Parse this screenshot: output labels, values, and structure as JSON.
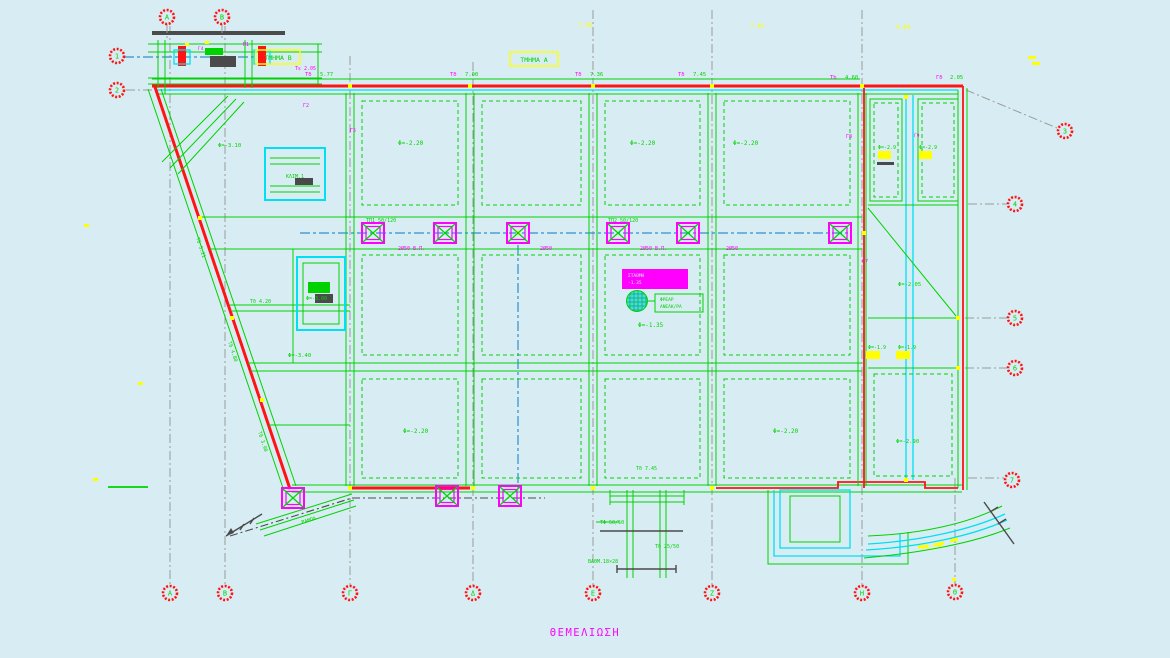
{
  "drawing": {
    "title": "ΘΕΜΕΛΙΩΣΗ",
    "section_box_a": "ΤΜΗΜΑ Α",
    "section_box_b": "ΤΜΗΜΑ Β"
  },
  "colors": {
    "bg": "#d8edf3",
    "green": "#00d200",
    "red": "#ff1414",
    "cyan": "#00e0f2",
    "magenta": "#ff00ff",
    "yellow": "#ffff00",
    "blue": "#2f8fd0",
    "gray": "#9a9a9a",
    "dark": "#4a4a4a"
  },
  "grid": {
    "markers": [
      {
        "x": 170,
        "y": 593,
        "label": "Α"
      },
      {
        "x": 225,
        "y": 593,
        "label": "Β"
      },
      {
        "x": 350,
        "y": 593,
        "label": "Γ"
      },
      {
        "x": 473,
        "y": 593,
        "label": "Δ"
      },
      {
        "x": 593,
        "y": 593,
        "label": "Ε"
      },
      {
        "x": 712,
        "y": 593,
        "label": "Ζ"
      },
      {
        "x": 862,
        "y": 593,
        "label": "Η"
      },
      {
        "x": 955,
        "y": 592,
        "label": "Θ"
      },
      {
        "x": 167,
        "y": 17,
        "label": "Α"
      },
      {
        "x": 222,
        "y": 17,
        "label": "Β"
      },
      {
        "x": 117,
        "y": 56,
        "label": "1"
      },
      {
        "x": 117,
        "y": 90,
        "label": "2"
      },
      {
        "x": 1065,
        "y": 131,
        "label": "3"
      },
      {
        "x": 1015,
        "y": 204,
        "label": "4"
      },
      {
        "x": 1015,
        "y": 318,
        "label": "5"
      },
      {
        "x": 1015,
        "y": 368,
        "label": "6"
      },
      {
        "x": 1012,
        "y": 480,
        "label": "7"
      }
    ]
  },
  "structure": {
    "pile_caps": [
      {
        "x": 373,
        "y": 233
      },
      {
        "x": 445,
        "y": 233
      },
      {
        "x": 518,
        "y": 233
      },
      {
        "x": 618,
        "y": 233
      },
      {
        "x": 688,
        "y": 233
      },
      {
        "x": 840,
        "y": 233
      },
      {
        "x": 447,
        "y": 496
      },
      {
        "x": 510,
        "y": 496
      },
      {
        "x": 293,
        "y": 498
      }
    ]
  },
  "annotations": [
    {
      "t": "7.36",
      "c": "yellow",
      "x": 578,
      "y": 27,
      "s": 6
    },
    {
      "t": "7.45",
      "c": "yellow",
      "x": 750,
      "y": 28,
      "s": 6
    },
    {
      "t": "4.60",
      "c": "yellow",
      "x": 896,
      "y": 29,
      "s": 6
    },
    {
      "t": "Τδ",
      "c": "magenta",
      "x": 305,
      "y": 76,
      "s": 5.5
    },
    {
      "t": "5.77",
      "c": "green",
      "x": 320,
      "y": 76,
      "s": 5.5
    },
    {
      "t": "Τδ",
      "c": "magenta",
      "x": 450,
      "y": 76,
      "s": 5.5
    },
    {
      "t": "7.00",
      "c": "green",
      "x": 465,
      "y": 76,
      "s": 5.5
    },
    {
      "t": "Τδ",
      "c": "magenta",
      "x": 575,
      "y": 76,
      "s": 5.5
    },
    {
      "t": "7.36",
      "c": "green",
      "x": 590,
      "y": 76,
      "s": 5.5
    },
    {
      "t": "Τδ",
      "c": "magenta",
      "x": 678,
      "y": 76,
      "s": 5.5
    },
    {
      "t": "7.45",
      "c": "green",
      "x": 693,
      "y": 76,
      "s": 5.5
    },
    {
      "t": "Τb",
      "c": "magenta",
      "x": 830,
      "y": 79,
      "s": 5.5
    },
    {
      "t": "4.60",
      "c": "green",
      "x": 845,
      "y": 79,
      "s": 5.5
    },
    {
      "t": "Γδ",
      "c": "magenta",
      "x": 936,
      "y": 79,
      "s": 5.5
    },
    {
      "t": "2.05",
      "c": "green",
      "x": 950,
      "y": 79,
      "s": 5.5
    },
    {
      "t": "Φ=-2.20",
      "c": "green",
      "x": 398,
      "y": 145,
      "s": 6
    },
    {
      "t": "Φ=-2.20",
      "c": "green",
      "x": 630,
      "y": 145,
      "s": 6
    },
    {
      "t": "Φ=-2.20",
      "c": "green",
      "x": 733,
      "y": 145,
      "s": 6
    },
    {
      "t": "Φ=-3.10",
      "c": "green",
      "x": 218,
      "y": 147,
      "s": 5.5
    },
    {
      "t": "ΚΛΙΜ.1",
      "c": "green",
      "x": 286,
      "y": 178,
      "s": 5
    },
    {
      "t": "Φ=-3.60",
      "c": "green",
      "x": 306,
      "y": 300,
      "s": 5
    },
    {
      "t": "Φ=-1.35",
      "c": "green",
      "x": 638,
      "y": 327,
      "s": 6
    },
    {
      "t": "Φ=-2.20",
      "c": "green",
      "x": 403,
      "y": 433,
      "s": 6
    },
    {
      "t": "Φ=-2.20",
      "c": "green",
      "x": 773,
      "y": 433,
      "s": 6
    },
    {
      "t": "Φ=-3.40",
      "c": "green",
      "x": 288,
      "y": 357,
      "s": 5.5
    },
    {
      "t": "Φ=-2.05",
      "c": "green",
      "x": 898,
      "y": 286,
      "s": 5.5
    },
    {
      "t": "Φ=-2.90",
      "c": "green",
      "x": 896,
      "y": 443,
      "s": 5.5
    },
    {
      "t": "Φ=-2.9",
      "c": "green",
      "x": 878,
      "y": 149,
      "s": 5
    },
    {
      "t": "Φ=-2.9",
      "c": "green",
      "x": 919,
      "y": 149,
      "s": 5
    },
    {
      "t": "Φ=-1.9",
      "c": "green",
      "x": 868,
      "y": 349,
      "s": 5
    },
    {
      "t": "Φ=-1.9",
      "c": "green",
      "x": 898,
      "y": 349,
      "s": 5
    },
    {
      "t": "ΤΠ1 50/120",
      "c": "green",
      "x": 366,
      "y": 222,
      "s": 5
    },
    {
      "t": "ΤΠ2 50/120",
      "c": "green",
      "x": 608,
      "y": 222,
      "s": 5
    },
    {
      "t": "2Ø50 Β.Π.",
      "c": "magenta",
      "x": 398,
      "y": 250,
      "s": 5
    },
    {
      "t": "2Ø50",
      "c": "magenta",
      "x": 540,
      "y": 250,
      "s": 5
    },
    {
      "t": "2Ø50 Β.Π.",
      "c": "magenta",
      "x": 640,
      "y": 250,
      "s": 5
    },
    {
      "t": "2Ø50",
      "c": "magenta",
      "x": 726,
      "y": 250,
      "s": 5
    },
    {
      "t": "Τδ 5.21",
      "c": "green",
      "x": 196,
      "y": 238,
      "s": 5,
      "rot": 72
    },
    {
      "t": "Τδ 4.80",
      "c": "green",
      "x": 228,
      "y": 342,
      "s": 5,
      "rot": 72
    },
    {
      "t": "Τδ 3.90",
      "c": "green",
      "x": 258,
      "y": 432,
      "s": 5,
      "rot": 72
    },
    {
      "t": "ΦΡΕΑΡ",
      "c": "green",
      "x": 660,
      "y": 301,
      "s": 4.5
    },
    {
      "t": "ΑΝΕΛΚ/ΡΑ",
      "c": "green",
      "x": 660,
      "y": 308,
      "s": 4.5
    },
    {
      "t": "ΣΤΑΘΜΗ",
      "c": "bg",
      "x": 628,
      "y": 277,
      "s": 4.5
    },
    {
      "t": "-1.35",
      "c": "bg",
      "x": 628,
      "y": 284,
      "s": 4.5
    },
    {
      "t": "ΤΦ 50/50",
      "c": "green",
      "x": 600,
      "y": 524,
      "s": 5
    },
    {
      "t": "ΒΑΘΜ.18×28",
      "c": "green",
      "x": 588,
      "y": 563,
      "s": 5
    },
    {
      "t": "Τδ 25/50",
      "c": "green",
      "x": 655,
      "y": 548,
      "s": 5
    },
    {
      "t": "Τδ 7.45",
      "c": "green",
      "x": 636,
      "y": 470,
      "s": 5
    },
    {
      "t": "ΡΑΜΠΑ",
      "c": "green",
      "x": 302,
      "y": 524,
      "s": 5,
      "rot": -17
    },
    {
      "t": "R=12.50",
      "c": "yellow",
      "x": 922,
      "y": 550,
      "s": 5,
      "rot": -9
    },
    {
      "t": "Γ8",
      "c": "magenta",
      "x": 846,
      "y": 138,
      "s": 5
    },
    {
      "t": "Γ9",
      "c": "magenta",
      "x": 914,
      "y": 137,
      "s": 4.5
    },
    {
      "t": "Γ5",
      "c": "magenta",
      "x": 350,
      "y": 132,
      "s": 5
    },
    {
      "t": "Γ2",
      "c": "magenta",
      "x": 303,
      "y": 107,
      "s": 5
    },
    {
      "t": "Π1",
      "c": "magenta",
      "x": 243,
      "y": 46,
      "s": 5
    },
    {
      "t": "Γ4",
      "c": "magenta",
      "x": 198,
      "y": 50,
      "s": 4.5
    },
    {
      "t": "Τε 2.05",
      "c": "magenta",
      "x": 295,
      "y": 70,
      "s": 5
    },
    {
      "t": "Γ7",
      "c": "magenta",
      "x": 862,
      "y": 263,
      "s": 5
    },
    {
      "t": "Τδ 4.20",
      "c": "green",
      "x": 250,
      "y": 303,
      "s": 5
    }
  ]
}
